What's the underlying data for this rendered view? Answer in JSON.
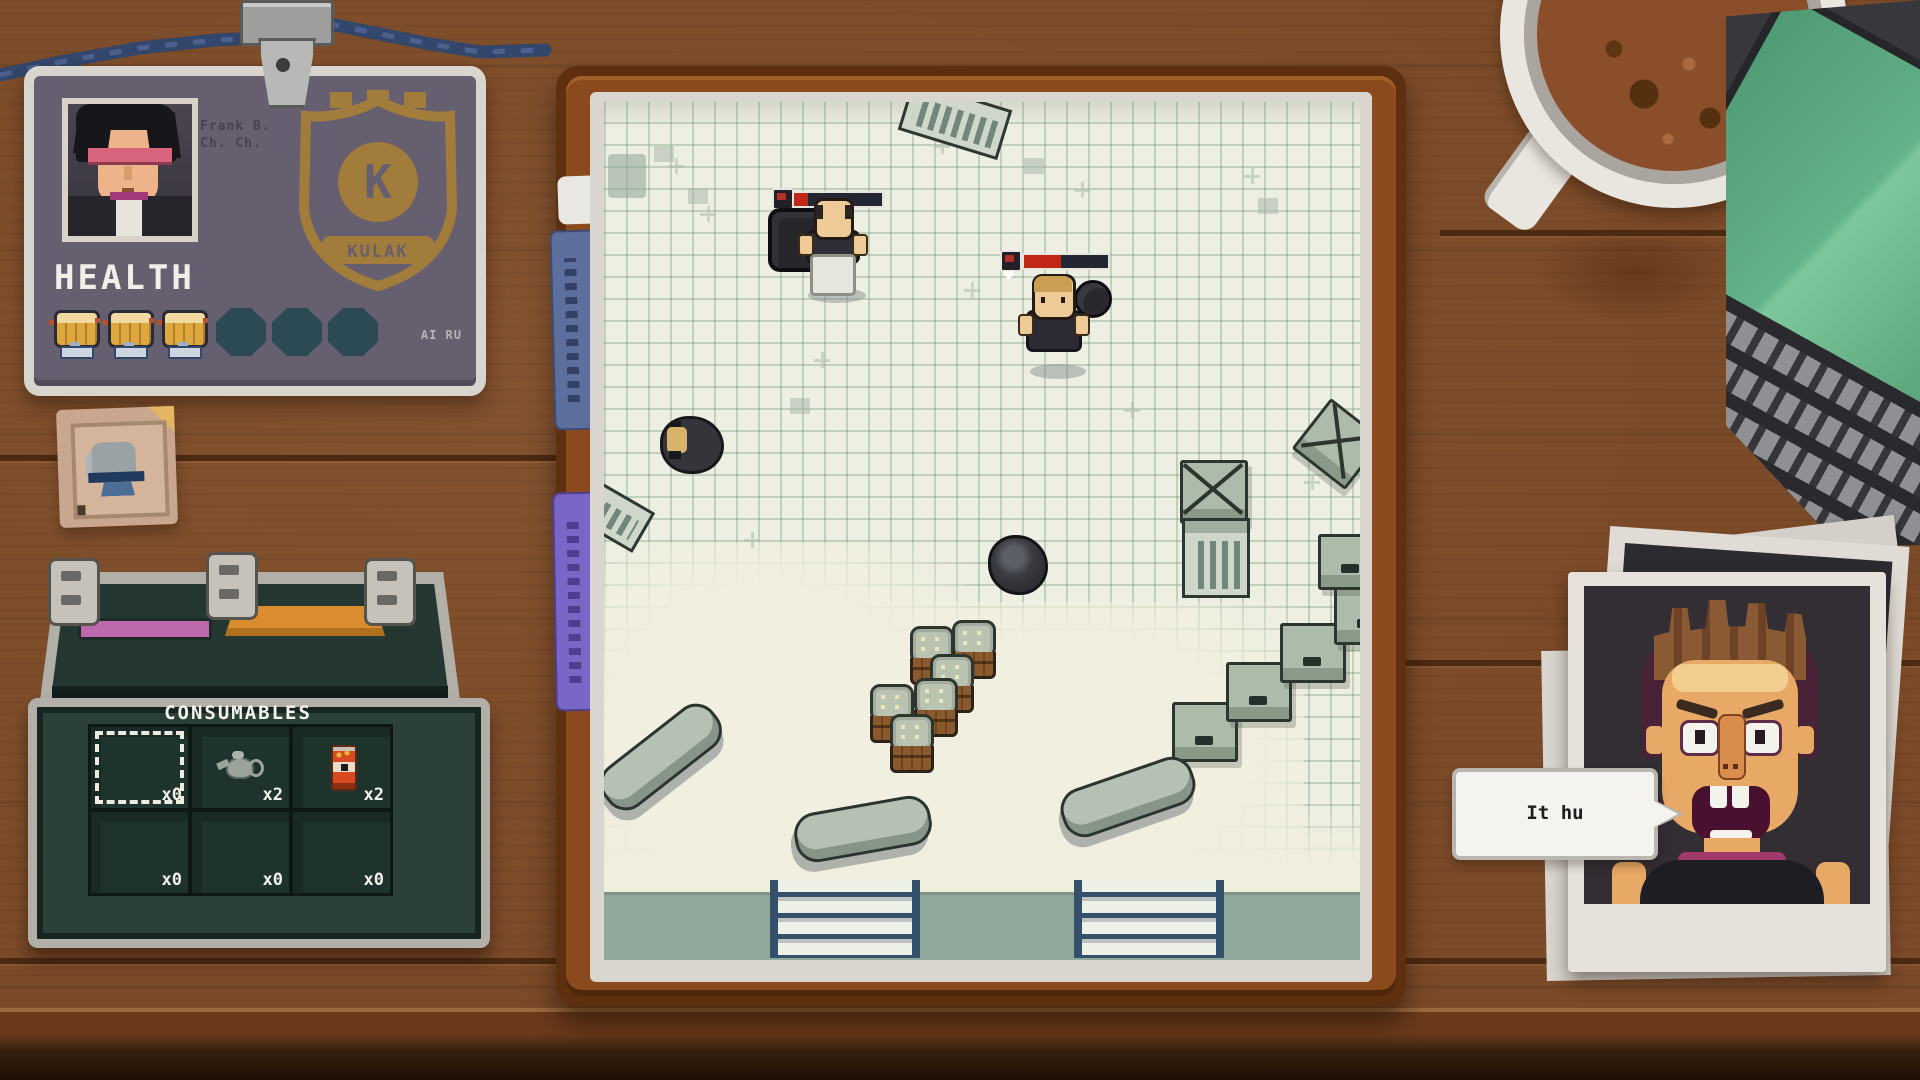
{
  "id_card": {
    "health_label": "HEALTH",
    "id_text_line1": "Frank B.",
    "id_text_line2": "Ch. Ch.",
    "badge_letter": "K",
    "badge_banner": "KULAK",
    "watermark": "AI RU",
    "health_filled": 3,
    "health_max": 6
  },
  "battlefield": {
    "enemy_hp_percents": [
      16,
      44
    ],
    "enemy_count": 2
  },
  "inventory": {
    "title": "CONSUMABLES",
    "slots": [
      {
        "count": "x0",
        "item": "empty-selected"
      },
      {
        "count": "x2",
        "item": "teapot"
      },
      {
        "count": "x2",
        "item": "soda-can"
      },
      {
        "count": "x0",
        "item": "empty"
      },
      {
        "count": "x0",
        "item": "empty"
      },
      {
        "count": "x0",
        "item": "empty"
      }
    ]
  },
  "dialogue": {
    "text": "It hu"
  },
  "colors": {
    "hp_red": "#c22818",
    "wood": "#7b4a28",
    "paper": "#edefe2",
    "card_bg": "#665f70",
    "case_green": "#2b4138",
    "tab_blue": "#5d6f9d",
    "tab_purple": "#7a66c6",
    "badge_gold": "#a87f36",
    "bubble_white": "#f5f3ef"
  }
}
